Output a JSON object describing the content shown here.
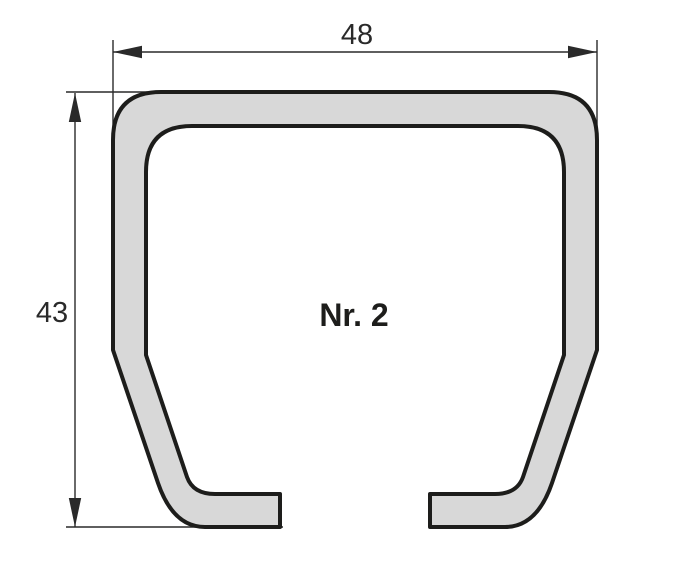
{
  "diagram": {
    "type": "technical-cross-section",
    "profile_label": "Nr. 2",
    "dimensions": {
      "width_label": "48",
      "height_label": "43"
    },
    "colors": {
      "background": "#ffffff",
      "profile_fill": "#d8d8d8",
      "profile_outline": "#1d1d1b",
      "dimension_lines": "#2a2a2a",
      "text": "#2a2a2a"
    }
  }
}
